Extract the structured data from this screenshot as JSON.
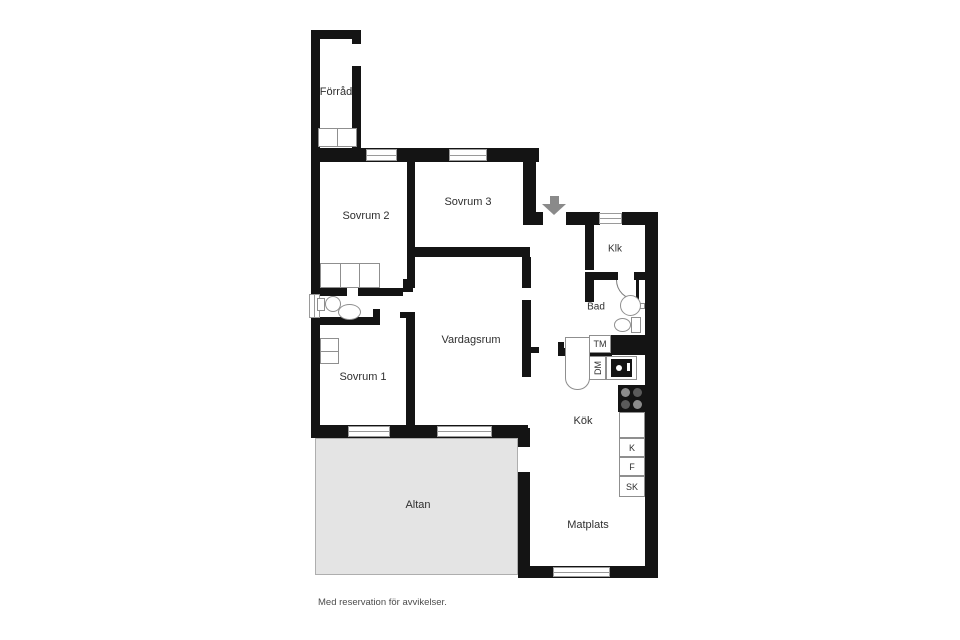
{
  "floorplan": {
    "rooms": {
      "forrad": "Förråd",
      "sovrum2": "Sovrum 2",
      "sovrum3": "Sovrum 3",
      "klk": "Klk",
      "bad": "Bad",
      "vardagsrum": "Vardagsrum",
      "sovrum1": "Sovrum 1",
      "kok": "Kök",
      "matplats": "Matplats",
      "altan": "Altan"
    },
    "appliances": {
      "tm": "TM",
      "dm": "DM",
      "k": "K",
      "f": "F",
      "sk": "SK"
    },
    "disclaimer": "Med reservation för avvikelser.",
    "colors": {
      "wall": "#141414",
      "terrace_fill": "#e4e4e4",
      "entrance_arrow": "#8a8a8a",
      "background": "#ffffff"
    }
  }
}
